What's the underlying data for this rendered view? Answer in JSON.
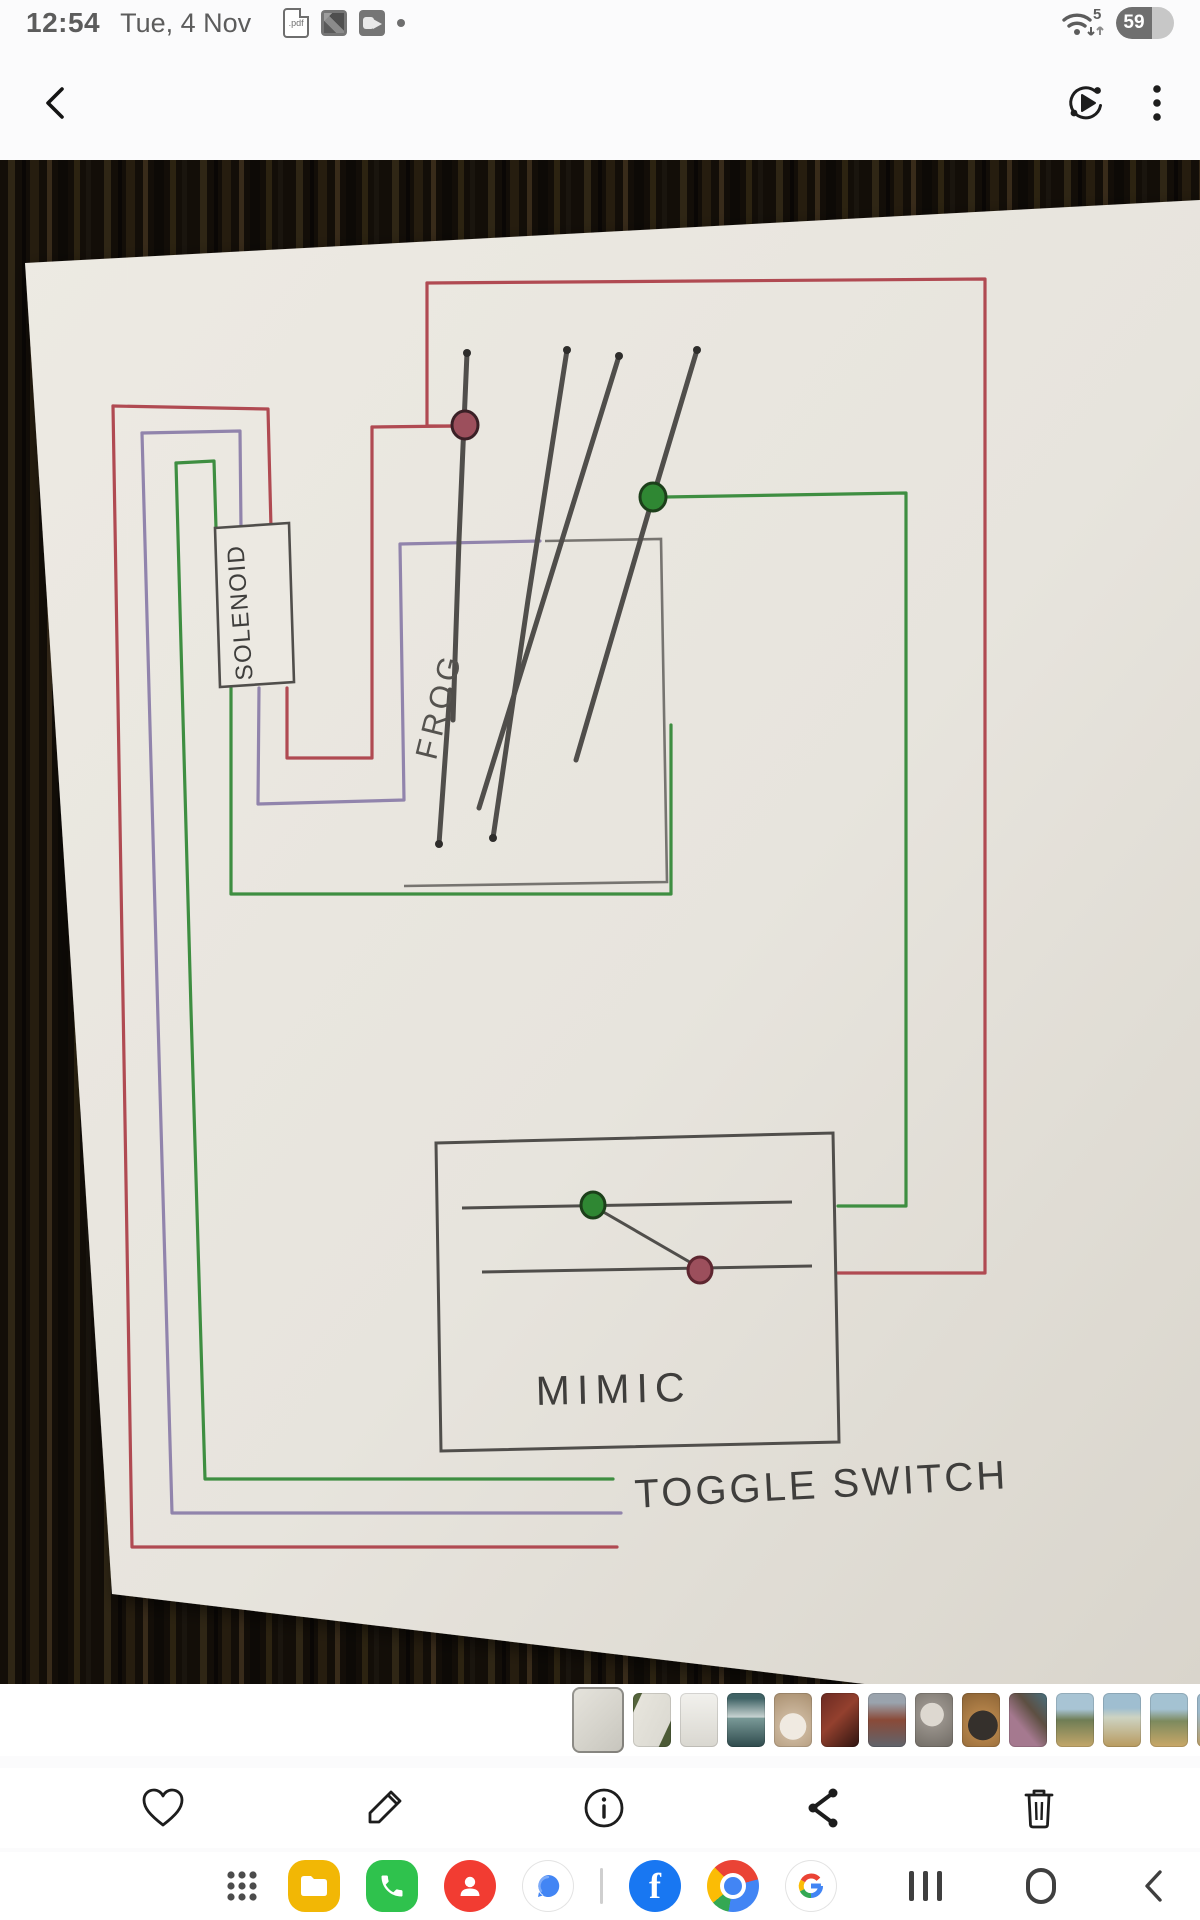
{
  "status_bar": {
    "time": "12:54",
    "date": "Tue, 4 Nov",
    "pdf_badge": ".pdf",
    "wifi_badge": "5",
    "battery_percent": "59"
  },
  "app_bar": {
    "back_icon": "back-chevron",
    "motion_icon": "motion-photo",
    "menu_icon": "more-vertical"
  },
  "photo": {
    "labels": {
      "solenoid": "SOLENOID",
      "frog": "FROG",
      "mimic": "MIMIC",
      "toggle_switch": "TOGGLE SWITCH"
    }
  },
  "theme": {
    "wire-red": "#b04a52",
    "wire-green": "#3e8e41",
    "wire-purple": "#9184ac",
    "pencil": "#504e4b",
    "led-red": "#9c4f5c",
    "led-green": "#2f8733",
    "paper": "#e9e6df"
  },
  "thumbnails": {
    "items": [
      {
        "name": "thumb-current-diagram",
        "selected": true,
        "bg": "linear-gradient(135deg,#e6e4dd 0%,#d4d2ca 60%,#c6c4bc 100%)"
      },
      {
        "name": "thumb-diagram-on-grass",
        "selected": false,
        "bg": "linear-gradient(115deg,#55643c 14%,#e6e4dc 15%,#dcdad2 80%,#4c5a36 81%)"
      },
      {
        "name": "thumb-document",
        "selected": false,
        "bg": "linear-gradient(180deg,#f2f1ed,#d9d7d0)"
      },
      {
        "name": "thumb-phone-screenshot",
        "selected": false,
        "bg": "linear-gradient(180deg,#3f6265 10%,#c9d4d2 45%,#7a9a98 46%,#2e4a4c)"
      },
      {
        "name": "thumb-white-dog",
        "selected": false,
        "bg": "radial-gradient(circle at 50% 62%,#f0eae1 34%,#c9b49a 35%,#a98f6f)"
      },
      {
        "name": "thumb-red-machine",
        "selected": false,
        "bg": "linear-gradient(135deg,#6b2a22,#93402e 45%,#2f1410)"
      },
      {
        "name": "thumb-model-train",
        "selected": false,
        "bg": "linear-gradient(180deg,#9aa3ad 18%,#8a4a38 50%,#60646c)"
      },
      {
        "name": "thumb-puppy-floor",
        "selected": false,
        "bg": "radial-gradient(circle at 45% 40%,#ddd8d0 30%,#97918a 31%,#6f6a63)"
      },
      {
        "name": "thumb-black-dog",
        "selected": false,
        "bg": "radial-gradient(circle at 55% 60%,#35302c 38%,#b08048 39%,#8a6234)"
      },
      {
        "name": "thumb-cat-blanket",
        "selected": false,
        "bg": "linear-gradient(50deg,#a5798f 35%,#5d4f42 65%,#49707f)"
      },
      {
        "name": "thumb-rv-field-1",
        "selected": false,
        "bg": "linear-gradient(180deg,#a8c4d4 30%,#6f7d55 50%,#c4a76a)"
      },
      {
        "name": "thumb-rv-field-2",
        "selected": false,
        "bg": "linear-gradient(180deg,#9fbed0 28%,#cdd3c2 45%,#b89a5e)"
      },
      {
        "name": "thumb-rv-field-3",
        "selected": false,
        "bg": "linear-gradient(180deg,#a4c2d2 30%,#7d8a5e 52%,#caa868)"
      },
      {
        "name": "thumb-rv-field-4",
        "selected": false,
        "bg": "linear-gradient(180deg,#9cb9cb 35%,#b99c62)"
      }
    ]
  },
  "toolbar": {
    "favorite": "heart",
    "edit": "pencil",
    "details": "info",
    "share": "share",
    "delete": "trash"
  },
  "dock": {
    "facebook_letter": "f"
  }
}
